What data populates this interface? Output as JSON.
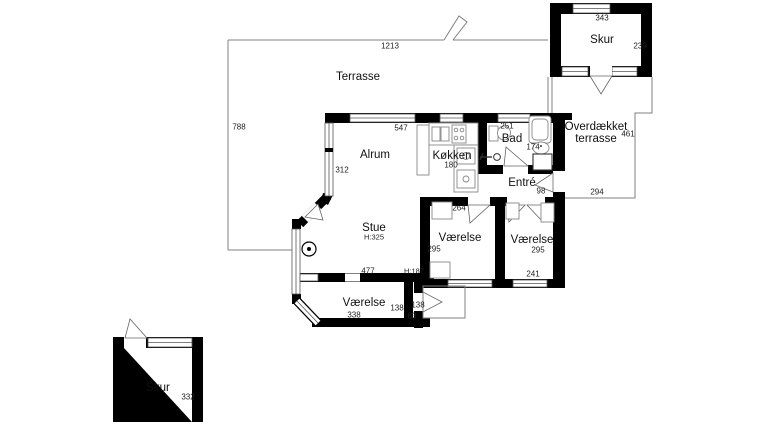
{
  "plan": {
    "rooms": {
      "terrasse": "Terrasse",
      "skur_top": "Skur",
      "skur_bottom": "Skur",
      "alrum": "Alrum",
      "kokken": "Køkken",
      "bad": "Bad",
      "entre": "Entré",
      "stue": "Stue",
      "vaerelse_left": "Værelse",
      "vaerelse_right": "Værelse",
      "vaerelse_bottom": "Værelse",
      "overdaekket_line1": "Overdækket",
      "overdaekket_line2": "terrasse"
    },
    "dims": {
      "t1213": "1213",
      "t788": "788",
      "s343": "343",
      "s239": "239",
      "a547": "547",
      "a312": "312",
      "k180": "180",
      "b251": "251",
      "b174": "174",
      "o461": "461",
      "o294": "294",
      "e98": "98",
      "vl264": "264",
      "vl295": "295",
      "vr295": "295",
      "vr241": "241",
      "st477": "477",
      "vb338": "338",
      "n138a": "138",
      "n138b": "138",
      "d63": "63",
      "sb332": "332",
      "h325": "H:325",
      "h187": "H:187"
    }
  }
}
